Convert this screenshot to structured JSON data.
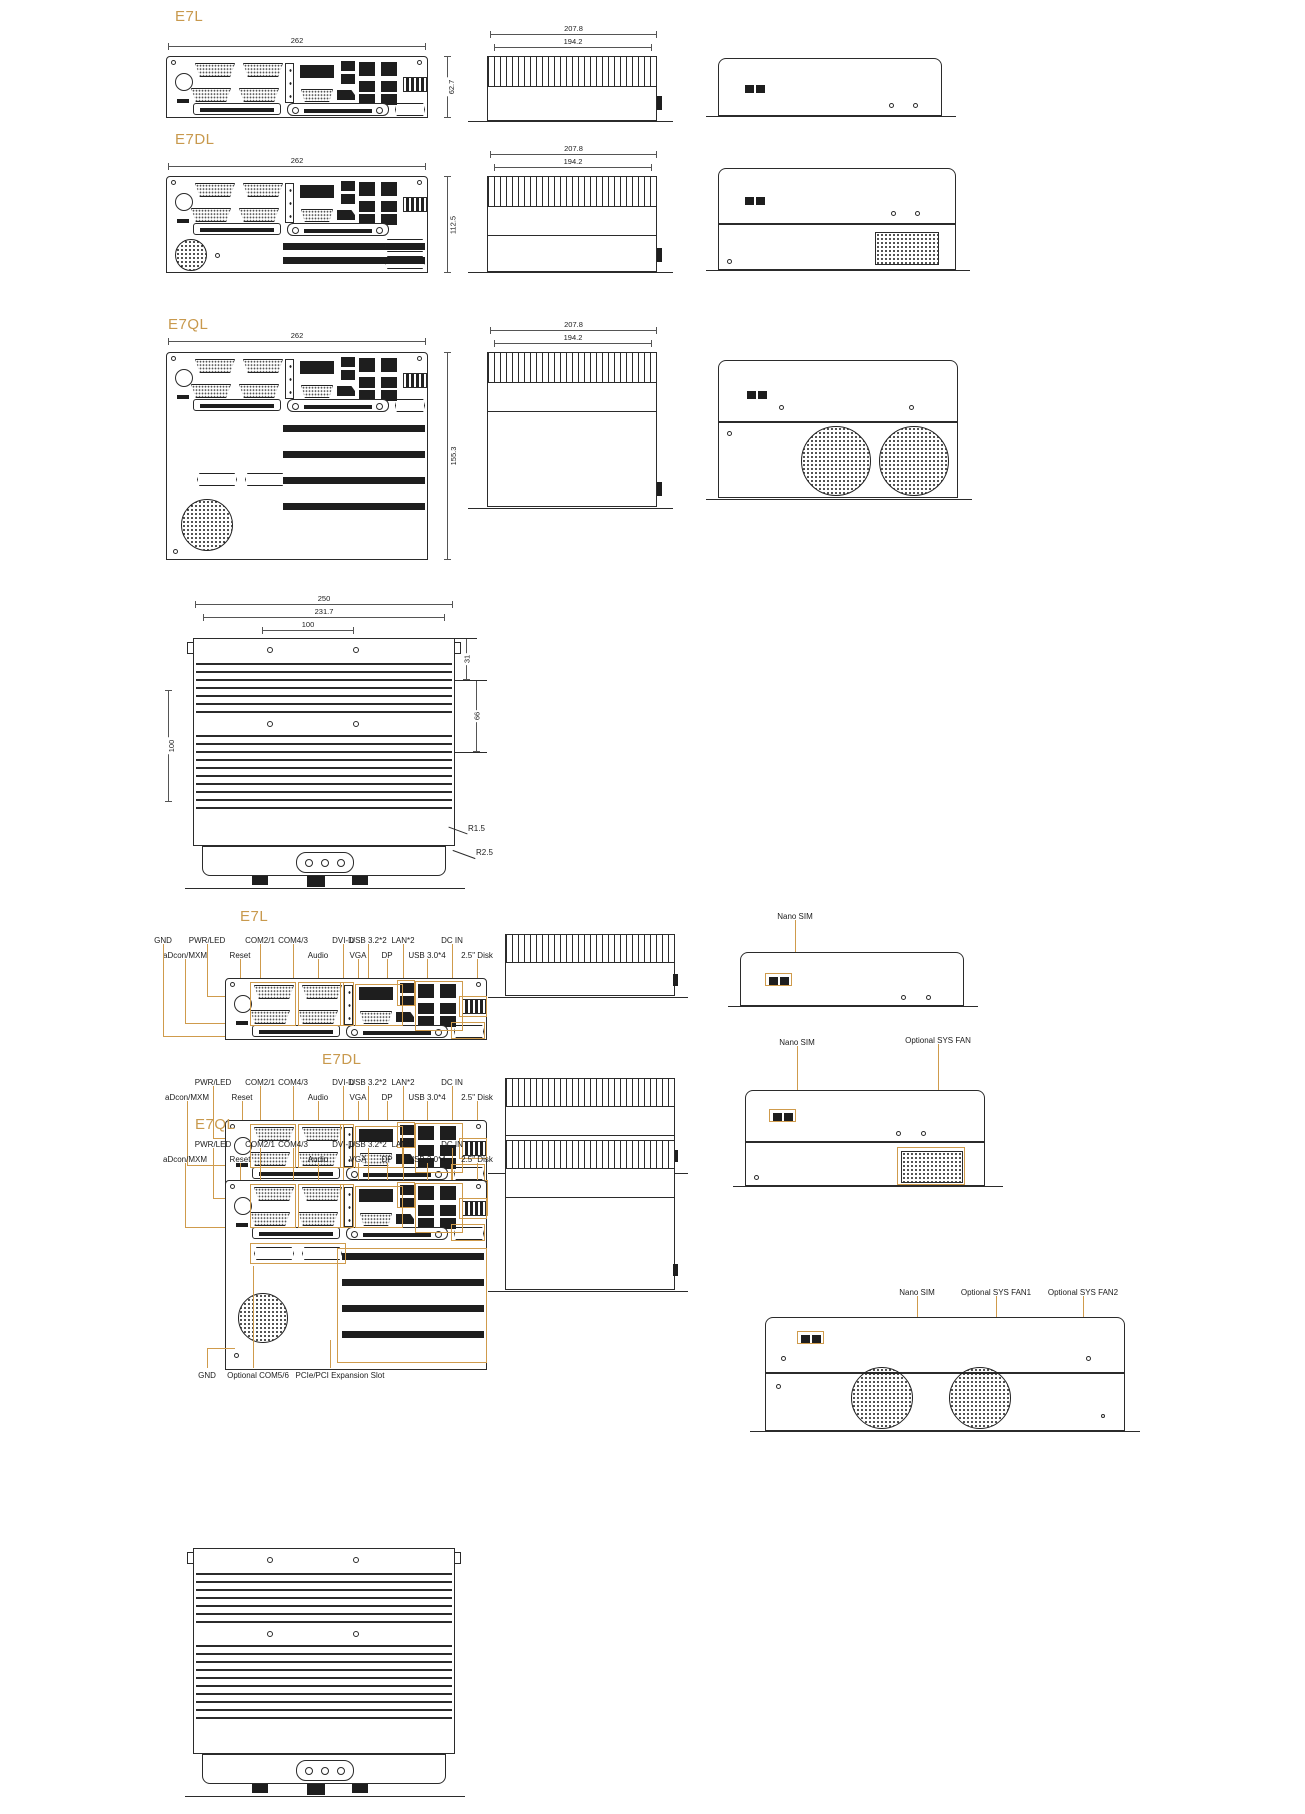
{
  "accent": "#cf9b4c",
  "models": [
    {
      "name": "E7L",
      "width": "262",
      "depth": "207.8",
      "depth_inner": "194.2",
      "height": "62.7"
    },
    {
      "name": "E7DL",
      "width": "262",
      "depth": "207.8",
      "depth_inner": "194.2",
      "height": "112.5"
    },
    {
      "name": "E7QL",
      "width": "262",
      "depth": "207.8",
      "depth_inner": "194.2",
      "height": "155.3"
    }
  ],
  "top_view": {
    "width": "250",
    "width_inner": "231.7",
    "mount": "100",
    "left": "100",
    "right_top": "31",
    "right_mid": "66",
    "r_small": "R1.5",
    "r_large": "R2.5"
  },
  "io": [
    {
      "labels": {
        "gnd": "GND",
        "pwrled": "PWR/LED",
        "com21": "COM2/1",
        "com43": "COM4/3",
        "dvid": "DVI-D",
        "usb32": "USB 3.2*2",
        "lan2": "LAN*2",
        "dcin": "DC IN",
        "adcon": "aDcon/MXM",
        "reset": "Reset",
        "audio": "Audio",
        "vga": "VGA",
        "dp": "DP",
        "usb30": "USB 3.0*4",
        "disk": "2.5\" Disk"
      },
      "rear": {
        "nano": "Nano SIM"
      }
    },
    {
      "labels": {
        "pwrled": "PWR/LED",
        "com21": "COM2/1",
        "com43": "COM4/3",
        "dvid": "DVI-D",
        "usb32": "USB 3.2*2",
        "lan2": "LAN*2",
        "dcin": "DC IN",
        "adcon": "aDcon/MXM",
        "reset": "Reset",
        "audio": "Audio",
        "vga": "VGA",
        "dp": "DP",
        "usb30": "USB 3.0*4",
        "disk": "2.5\" Disk"
      },
      "rear": {
        "nano": "Nano SIM",
        "fan": "Optional SYS FAN"
      },
      "bottom": {
        "slot": "PCIe/PCI Expansion Slot",
        "com56": "Optional COM5/6",
        "gnd": "GND"
      }
    },
    {
      "labels": {
        "pwrled": "PWR/LED",
        "com21": "COM2/1",
        "com43": "COM4/3",
        "dvid": "DVI-D",
        "usb32": "USB 3.2*2",
        "lan2": "LAN*2",
        "dcin": "DC IN",
        "adcon": "aDcon/MXM",
        "reset": "Reset",
        "audio": "Audio",
        "vga": "VGA",
        "dp": "DP",
        "usb30": "USB 3.0*4",
        "disk": "2.5\" Disk"
      },
      "rear": {
        "nano": "Nano SIM",
        "fan1": "Optional SYS FAN1",
        "fan2": "Optional SYS FAN2"
      },
      "bottom": {
        "gnd": "GND",
        "com56": "Optional COM5/6",
        "slot": "PCIe/PCI Expansion Slot"
      }
    }
  ]
}
